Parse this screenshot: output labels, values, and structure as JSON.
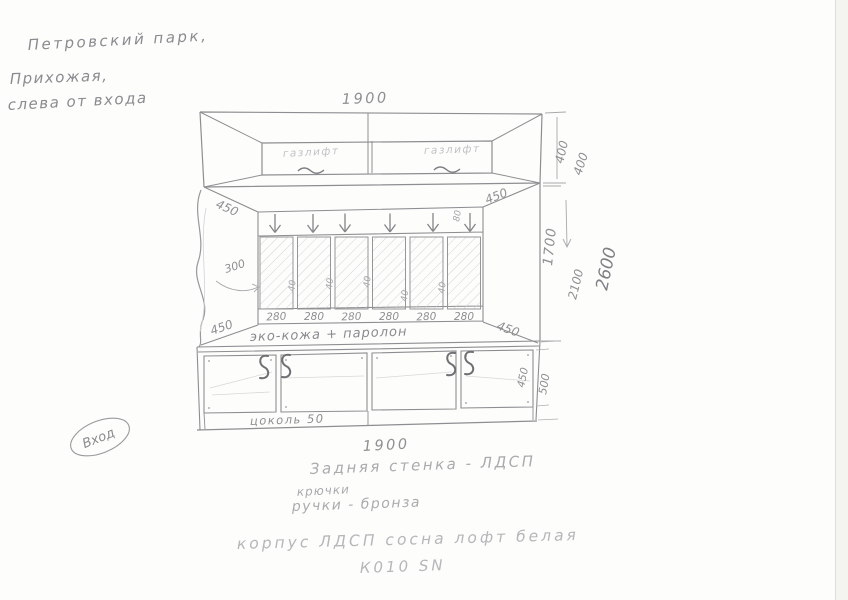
{
  "header_note": {
    "line1": "Петровский парк,",
    "line2": "Прихожая,",
    "line3": "слева от входа"
  },
  "upper_cabinet": {
    "width_label": "1900",
    "door_left_label": "газлифт",
    "door_right_label": "газлифт",
    "height_label": "400"
  },
  "middle_section": {
    "height_label": "1700",
    "depth_top_left": "450",
    "depth_top_right": "450",
    "depth_bottom_left": "450",
    "depth_bottom_right": "450",
    "shelf_depth_label": "300",
    "hook_gap_label": "80",
    "panel_labels": [
      "280",
      "280",
      "280",
      "280",
      "280",
      "280"
    ],
    "gap_labels": [
      "40",
      "40",
      "40",
      "40",
      "40"
    ],
    "upholstery_note": "эко-кожа + паролон"
  },
  "lower_cabinet": {
    "width_label": "1900",
    "plinth_label": "цоколь 50",
    "height_label": "450",
    "total_height_label": "500"
  },
  "right_dimensions": {
    "upper_addend": "400",
    "subtotal": "2100",
    "total": "2600"
  },
  "entrance_label": "Вход",
  "notes": {
    "back_wall": "Задняя стенка - ЛДСП",
    "hooks": "крючки",
    "handles": "ручки - бронза",
    "body_material": "корпус ЛДСП  сосна лофт белая",
    "decor_code": "К010 SN"
  },
  "colors": {
    "pencil": "#8e8e92",
    "pencil_light": "#b8b8bc",
    "paper": "#fdfdfb"
  }
}
